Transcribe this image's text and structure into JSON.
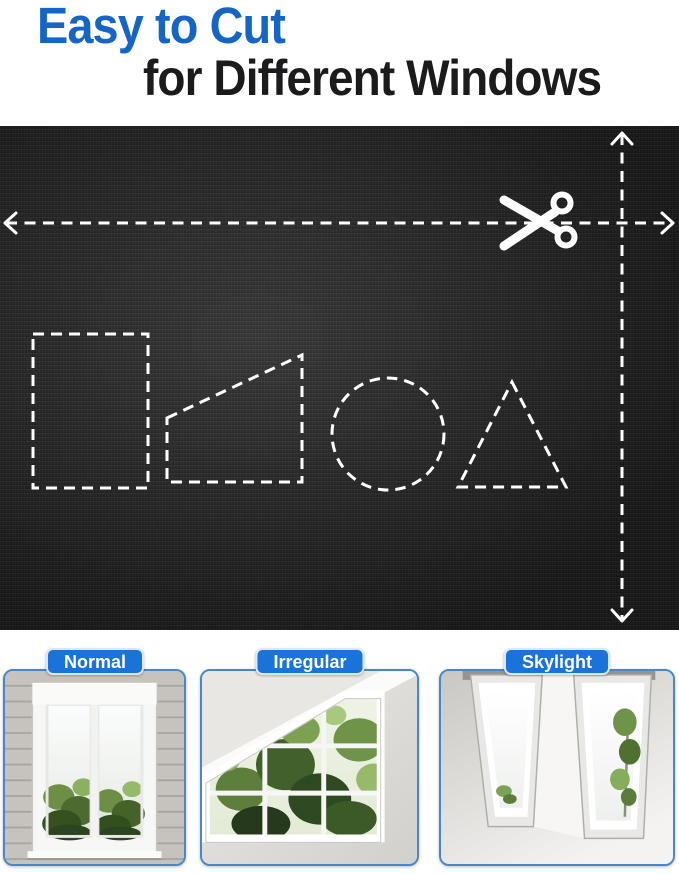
{
  "title": {
    "line1": "Easy to Cut",
    "line2": "for Different Windows"
  },
  "colors": {
    "title_blue": "#1565C5",
    "title_dark": "#1B1B1E",
    "label_blue": "#1973D8",
    "label_text": "#FFFFFF",
    "card_border_blue": "#4A86C8",
    "fabric_dark": "#282828",
    "guide_lines_white": "#FFFFFF"
  },
  "fabric_panel": {
    "icons": {
      "scissors": "scissors-icon",
      "horizontal_guide_arrows": [
        "arrow-left-icon",
        "arrow-right-icon"
      ],
      "vertical_guide_arrows": [
        "arrow-up-icon",
        "arrow-down-icon"
      ]
    },
    "cut_shape_templates": [
      "rectangle",
      "trapezoid",
      "circle",
      "triangle"
    ]
  },
  "window_types": [
    {
      "label": "Normal"
    },
    {
      "label": "Irregular"
    },
    {
      "label": "Skylight"
    }
  ]
}
